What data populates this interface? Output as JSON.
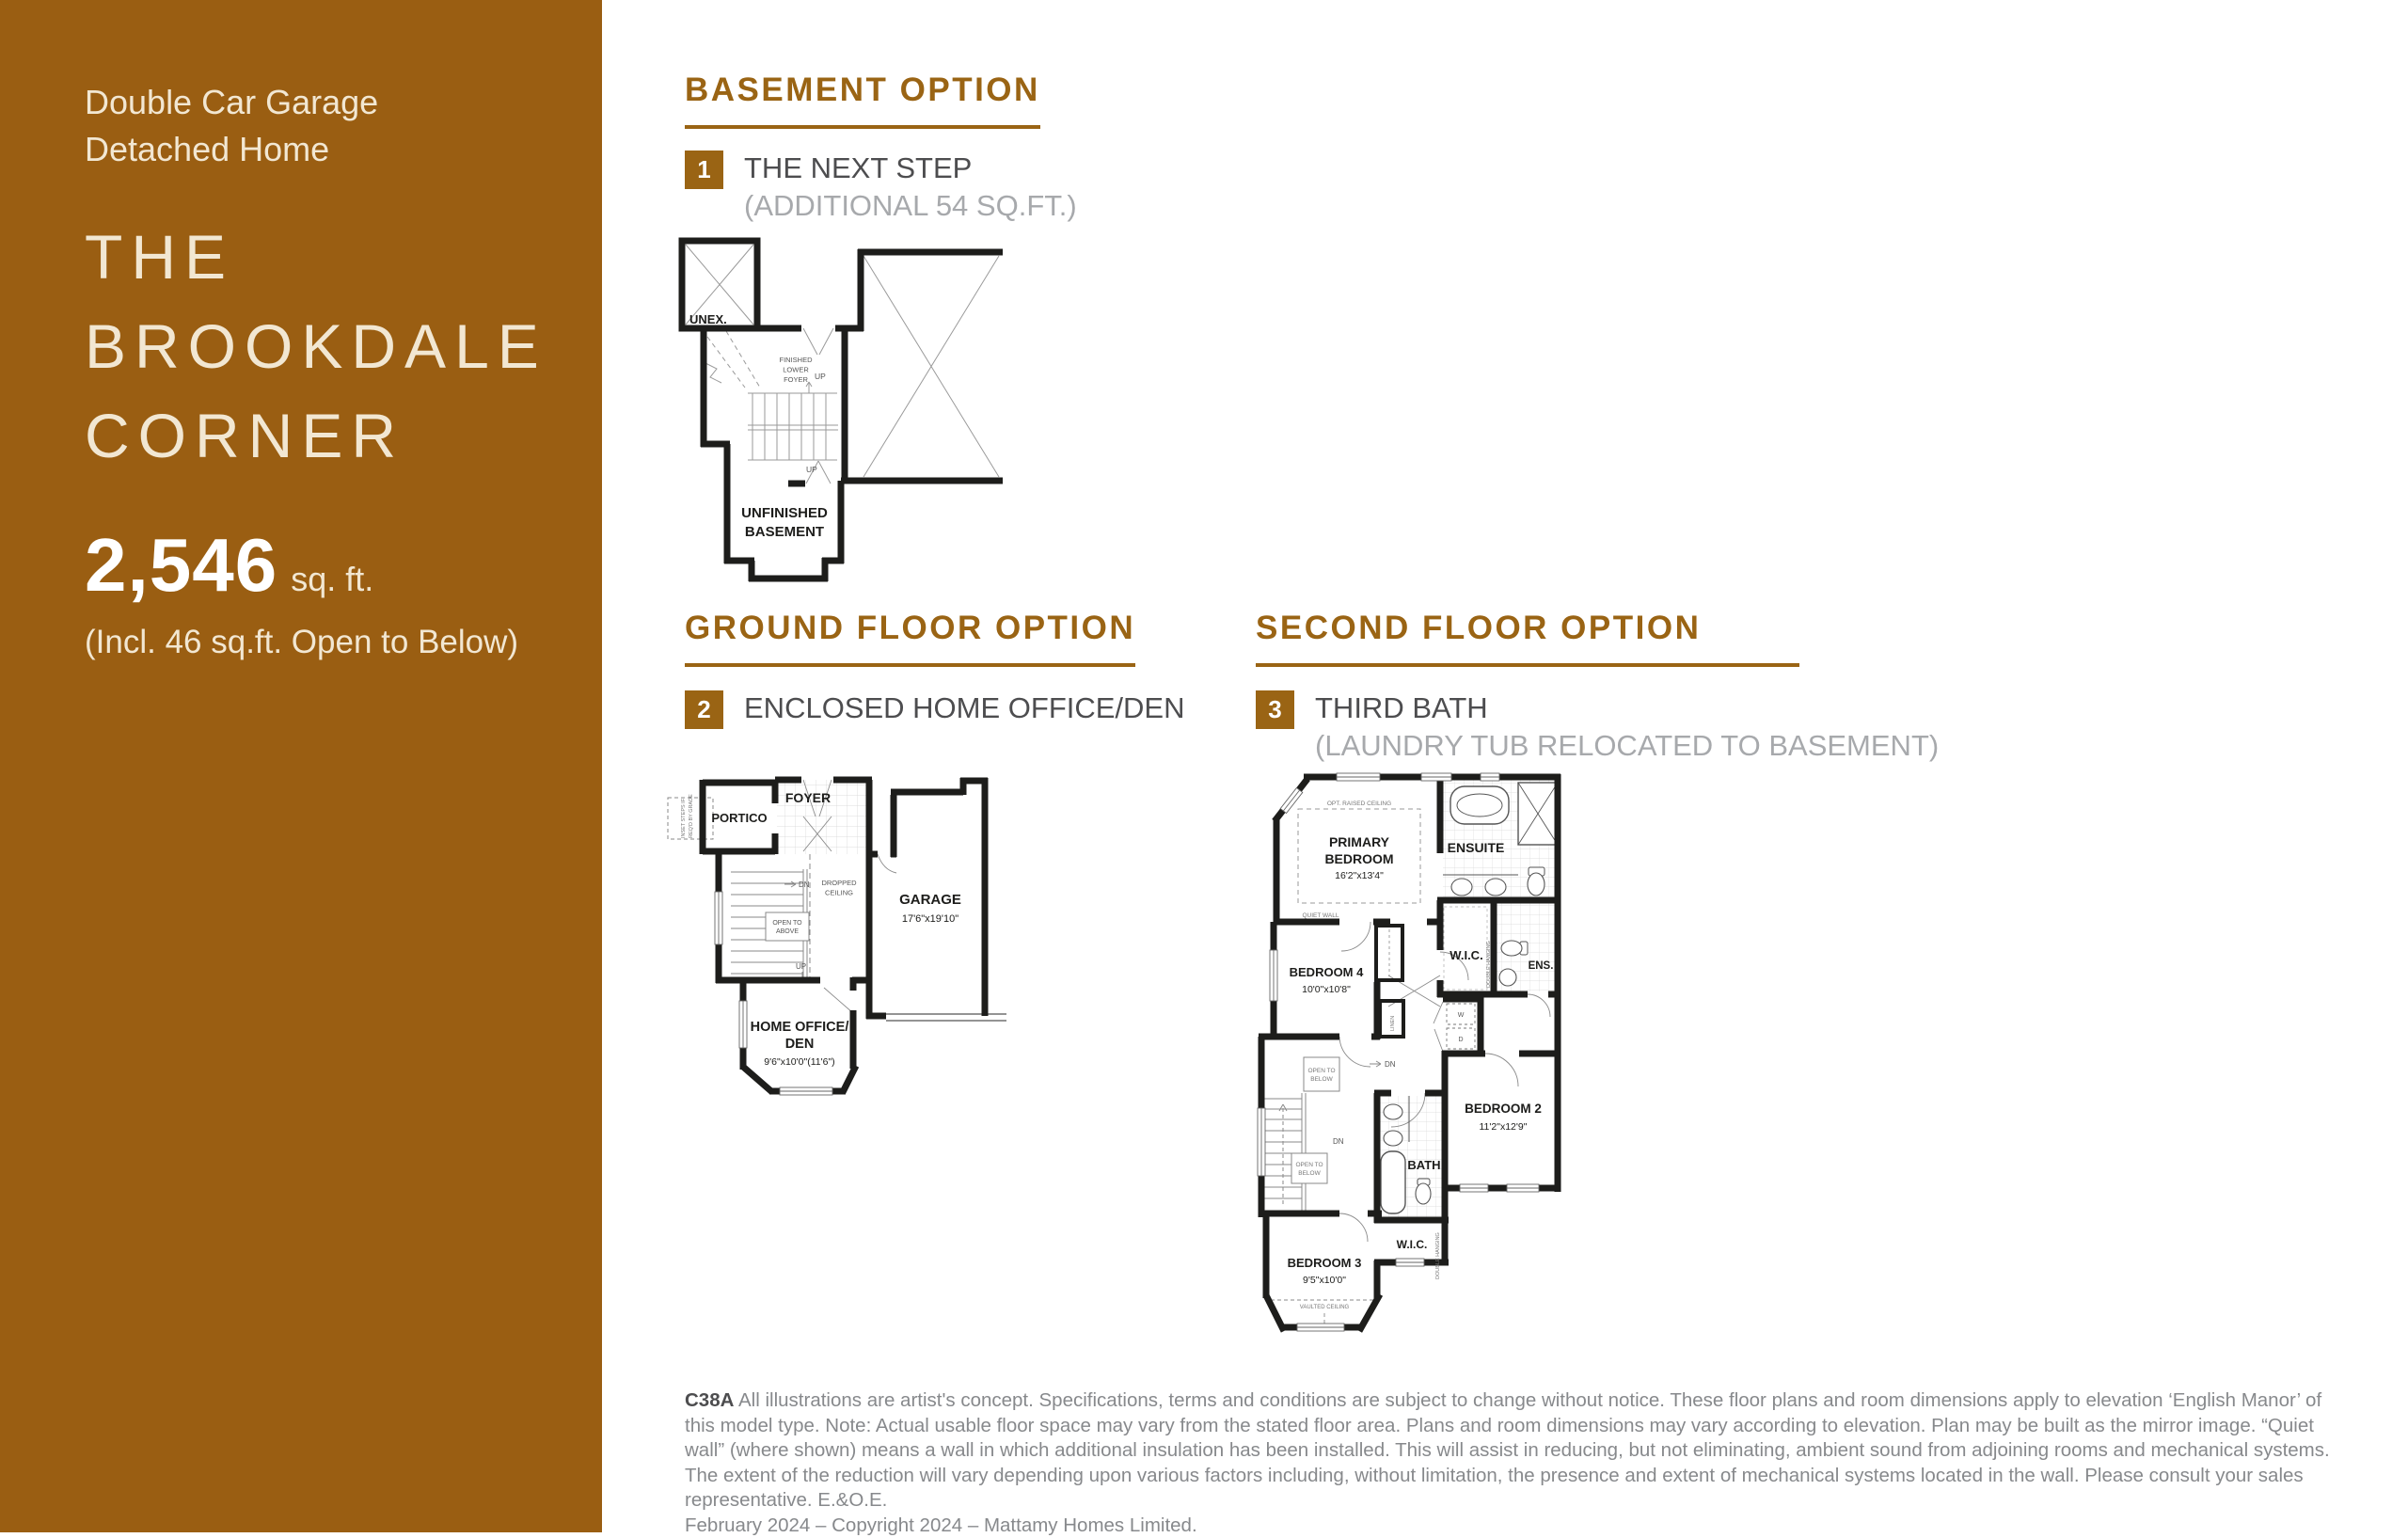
{
  "sidebar": {
    "subtitle_line1": "Double Car Garage",
    "subtitle_line2": "Detached Home",
    "title_line1": "THE",
    "title_line2": "BROOKDALE",
    "title_line3": "CORNER",
    "area_value": "2,546",
    "area_unit": "sq. ft.",
    "area_note": "(Incl. 46 sq.ft. Open to Below)"
  },
  "sections": {
    "basement": {
      "heading": "BASEMENT OPTION",
      "badge": "1",
      "title": "THE NEXT STEP",
      "subtitle": "(ADDITIONAL 54 SQ.FT.)"
    },
    "ground": {
      "heading": "GROUND FLOOR OPTION",
      "badge": "2",
      "title": "ENCLOSED HOME OFFICE/DEN",
      "subtitle": ""
    },
    "second": {
      "heading": "SECOND FLOOR OPTION",
      "badge": "3",
      "title": "THIRD BATH",
      "subtitle": "(LAUNDRY TUB RELOCATED TO BASEMENT)"
    }
  },
  "plans": {
    "basement": {
      "unex": "UNEX.",
      "foyer_l1": "FINISHED",
      "foyer_l2": "LOWER",
      "foyer_l3": "FOYER",
      "up": "UP",
      "up2": "UP",
      "basement_l1": "UNFINISHED",
      "basement_l2": "BASEMENT"
    },
    "ground": {
      "portico": "PORTICO",
      "foyer": "FOYER",
      "inset_l1": "INSET STEPS IF",
      "inset_l2": "REQ'D BY GRADE",
      "dn": "DN",
      "up": "UP",
      "dropped_l1": "DROPPED",
      "dropped_l2": "CEILING",
      "open_above_l1": "OPEN TO",
      "open_above_l2": "ABOVE",
      "garage": "GARAGE",
      "garage_dim": "17'6\"x19'10\"",
      "office_l1": "HOME OFFICE/",
      "office_l2": "DEN",
      "office_dim": "9'6\"x10'0\"(11'6\")"
    },
    "second": {
      "opt_ceiling": "OPT. RAISED CEILING",
      "primary_l1": "PRIMARY",
      "primary_l2": "BEDROOM",
      "primary_dim": "16'2\"x13'4\"",
      "ensuite": "ENSUITE",
      "quiet_wall": "QUIET WALL",
      "bedroom4": "BEDROOM 4",
      "bedroom4_dim": "10'0\"x10'8\"",
      "wic1": "W.I.C.",
      "double_hanging": "DOUBLE HANGING",
      "ens": "ENS.",
      "linen": "LINEN",
      "washer": "W",
      "dryer": "D",
      "open_below_l1": "OPEN TO",
      "open_below_l2": "BELOW",
      "open_below2_l1": "OPEN TO",
      "open_below2_l2": "BELOW",
      "dn": "DN",
      "dn2": "DN",
      "bath": "BATH",
      "bedroom2": "BEDROOM 2",
      "bedroom2_dim": "11'2\"x12'9\"",
      "wic2": "W.I.C.",
      "double_hanging2": "DOUBLE HANGING",
      "bedroom3": "BEDROOM 3",
      "bedroom3_dim": "9'5\"x10'0\"",
      "vaulted": "VAULTED CEILING"
    }
  },
  "footer": {
    "code": "C38A",
    "disclaimer": "All illustrations are artist's concept. Specifications, terms and conditions are subject to change without notice. These floor plans and room dimensions apply to elevation ‘English Manor’ of this model type. Note: Actual usable floor space may vary from the stated floor area. Plans and room dimensions may vary according to elevation. Plan may be built as the mirror image. “Quiet wall” (where shown) means a wall in which additional insulation has been installed. This will assist in reducing, but not eliminating, ambient sound from adjoining rooms and mechanical systems. The extent of the reduction will vary depending upon various factors including, without limitation, the presence and extent of mechanical systems located in the wall. Please consult your sales representative. E.&O.E.",
    "copyright": "February 2024 – Copyright 2024 – Mattamy Homes Limited."
  },
  "colors": {
    "brand_brown": "#9a5e12",
    "heading_brown": "#9a6414",
    "cream": "#f2e7d2",
    "white": "#ffffff",
    "title_dark": "#4d4d4f",
    "subtitle_gray": "#a7a9ac",
    "footer_gray": "#87898c",
    "wall_black": "#1d1d1b"
  }
}
